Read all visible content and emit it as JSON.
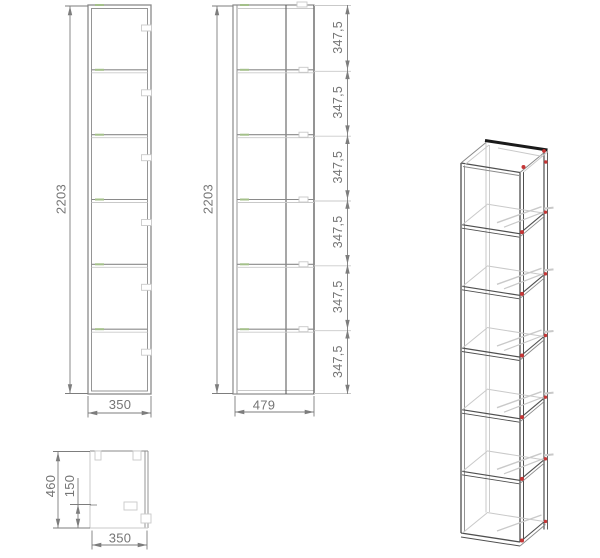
{
  "views": {
    "front": {
      "name": "front view",
      "height": "2203",
      "width": "350",
      "compartments": 6
    },
    "side": {
      "name": "side view",
      "height": "2203",
      "width": "479",
      "shelf_heights": [
        "347,5",
        "347,5",
        "347,5",
        "347,5",
        "347,5",
        "347,5"
      ]
    },
    "top": {
      "name": "top view",
      "depth": "460",
      "bracket_offset": "150",
      "width": "350"
    },
    "iso": {
      "name": "isometric view",
      "shelves": 6
    }
  },
  "colors": {
    "background": "#ffffff",
    "drawing_line": "#8a8a8a",
    "dark_line": "#4f4f4f",
    "light_line": "#c9c9c9",
    "dim_line": "#7d7d7d",
    "dim_text": "#757575",
    "iso_heavy_line": "#1a1a1a",
    "connector_red": "#c63636",
    "connector_green": "#a4c08a"
  }
}
